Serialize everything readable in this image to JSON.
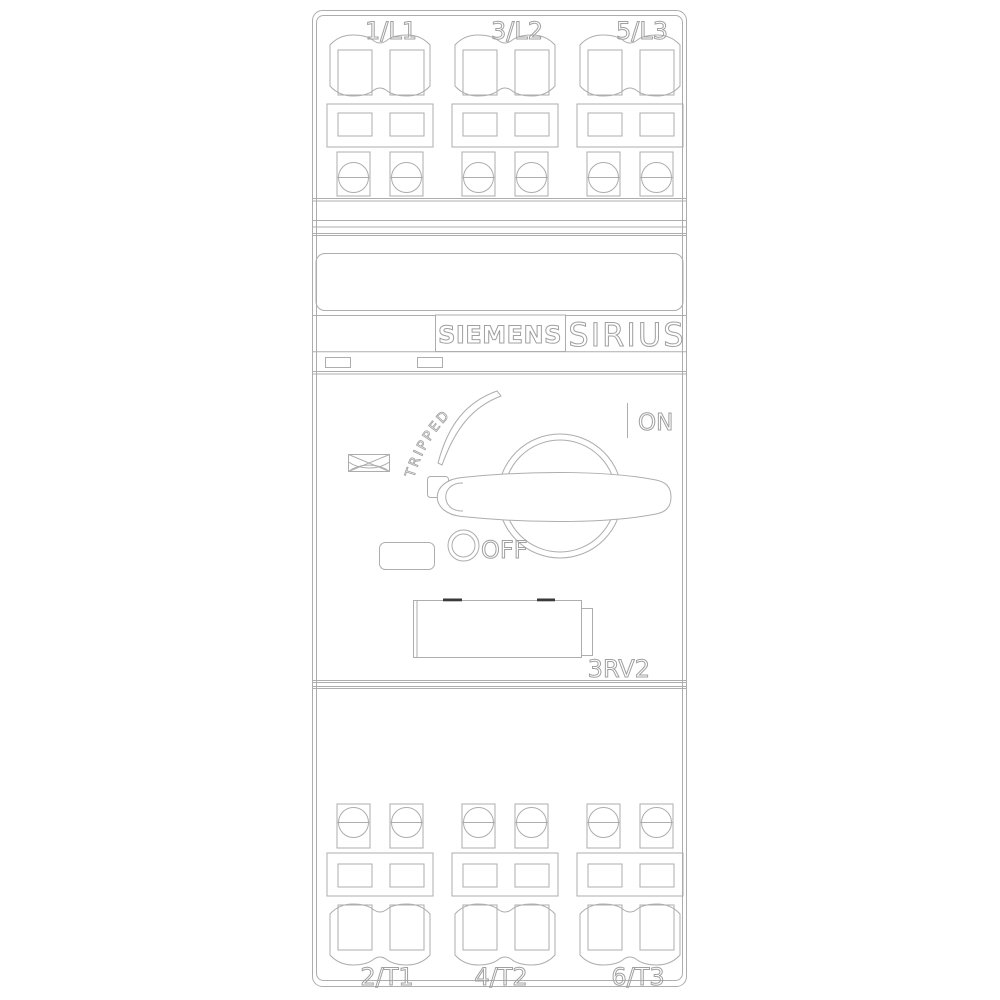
{
  "product": {
    "brand": "SIEMENS",
    "series": "SIRIUS",
    "model": "3RV2"
  },
  "terminals": {
    "top": [
      "1/L1",
      "3/L2",
      "5/L3"
    ],
    "bottom": [
      "2/T1",
      "4/T2",
      "6/T3"
    ]
  },
  "switch": {
    "tripped": "TRIPPED",
    "on": "ON",
    "off": "OFF"
  },
  "colors": {
    "background": "#ffffff",
    "line": "#adadad",
    "text": "#a0a0a0",
    "mark": "#3a3a3a"
  }
}
